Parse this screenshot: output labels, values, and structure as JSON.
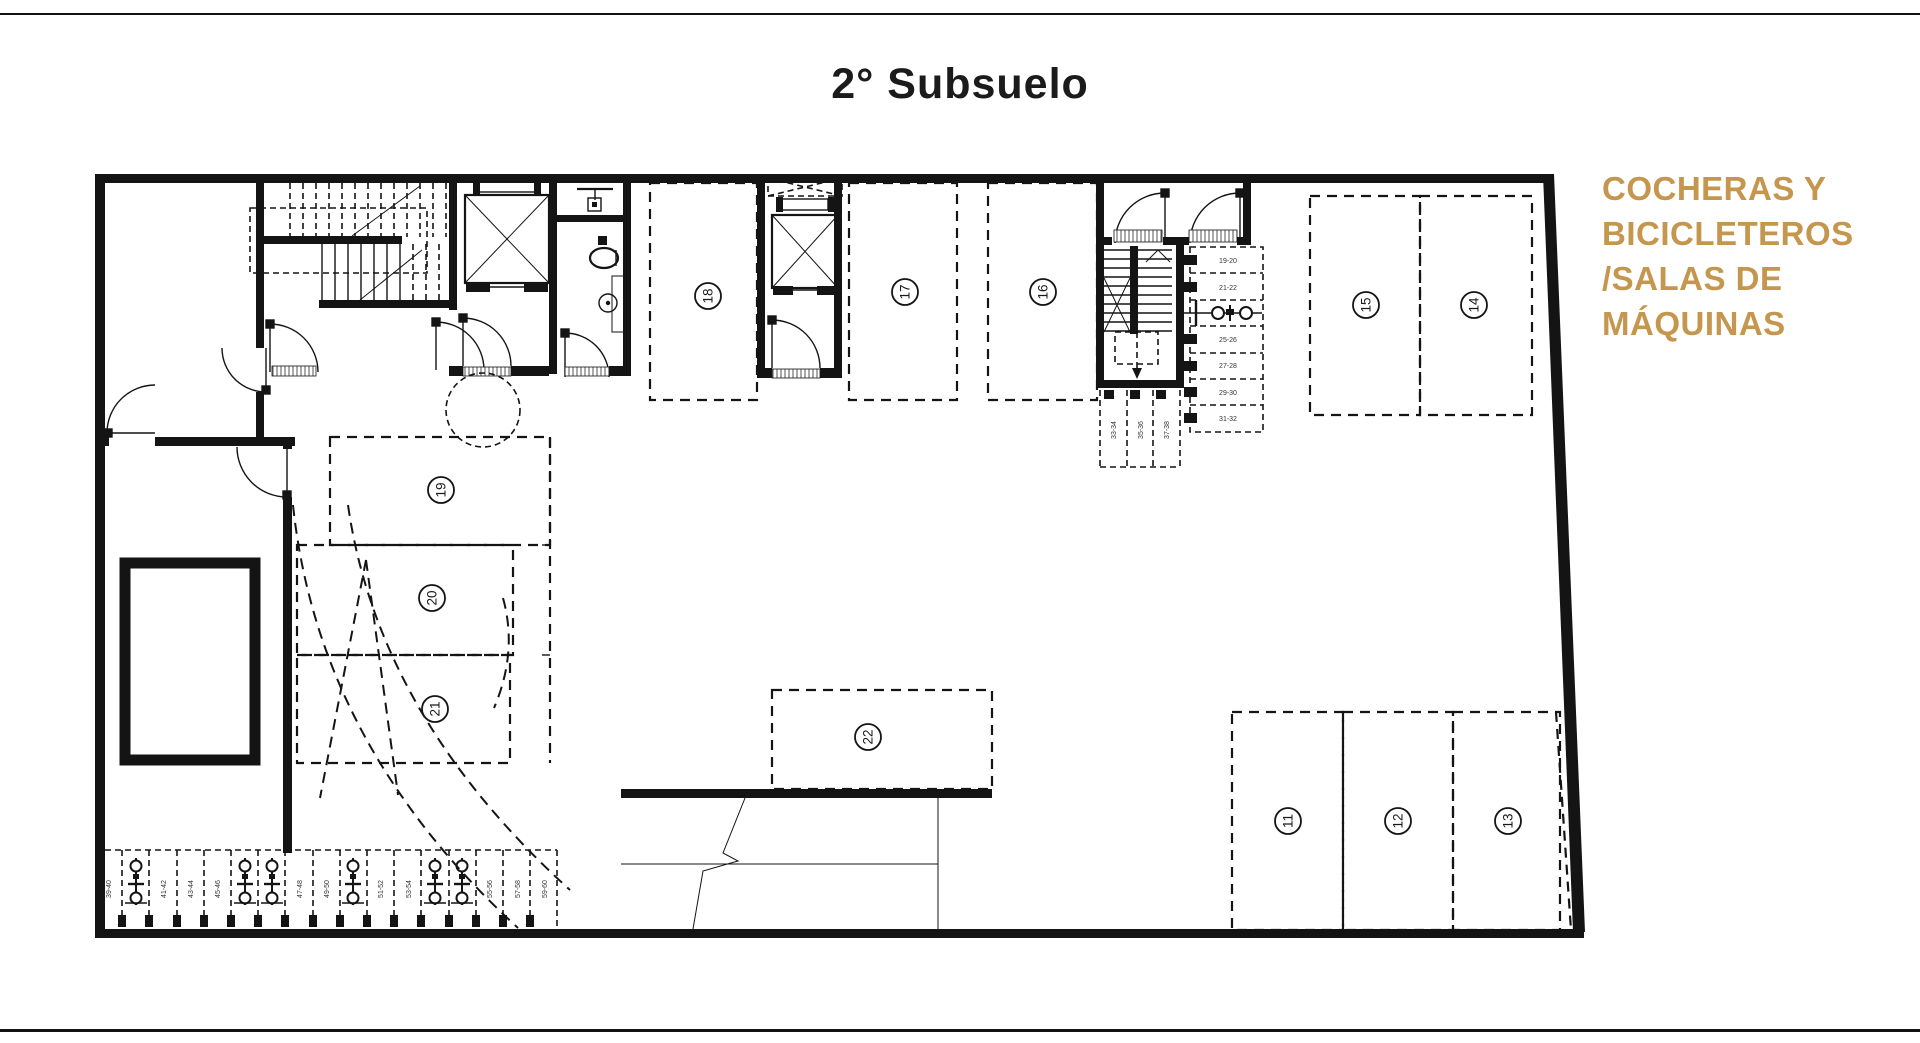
{
  "page": {
    "title": "2° Subsuelo"
  },
  "legend": {
    "color": "#c5964e",
    "lines": [
      "COCHERAS Y",
      "BICICLETEROS",
      "/SALAS DE",
      "MÁQUINAS"
    ]
  },
  "plan": {
    "stall_numbers": [
      "11",
      "12",
      "13",
      "14",
      "15",
      "16",
      "17",
      "18",
      "19",
      "20",
      "21",
      "22"
    ],
    "bike_labels_right": [
      "19-20",
      "21-22",
      "25-26",
      "27-28",
      "29-30",
      "31-32"
    ],
    "bike_labels_stair": [
      "33-34",
      "35-36",
      "37-38"
    ],
    "bike_labels_bottom": [
      "39-40",
      "41-42",
      "43-44",
      "45-46",
      "47-48",
      "49-50",
      "51-52",
      "53-54",
      "55-56",
      "57-58",
      "59-60"
    ]
  }
}
